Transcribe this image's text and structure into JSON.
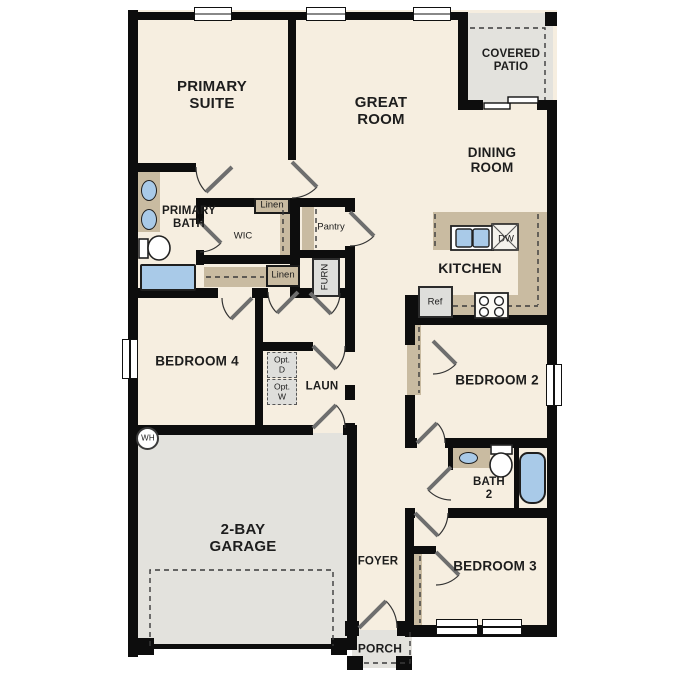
{
  "labels": {
    "primary_suite": "PRIMARY SUITE",
    "great_room": "GREAT ROOM",
    "covered_patio": "COVERED PATIO",
    "dining_room": "DINING ROOM",
    "primary_bath": "PRIMARY BATH",
    "wic": "WIC",
    "linen_upper": "Linen",
    "linen_lower": "Linen",
    "pantry": "Pantry",
    "furnace": "FURN",
    "kitchen": "KITCHEN",
    "dishwasher": "DW",
    "refrigerator": "Ref",
    "bedroom4": "BEDROOM 4",
    "opt_dryer": "Opt. D",
    "opt_washer": "Opt. W",
    "laundry": "LAUN",
    "bedroom2": "BEDROOM 2",
    "water_heater": "WH",
    "bath2": "BATH 2",
    "garage": "2-BAY GARAGE",
    "foyer": "FOYER",
    "bedroom3": "BEDROOM 3",
    "porch": "PORCH"
  },
  "colors": {
    "floor": "#f6eee0",
    "wall": "#0d0d0d",
    "casework": "#c9bba1",
    "concrete": "#e3e2dd",
    "fixture": "#a9cae8",
    "appliance": "#dededb",
    "line": "#2a2a2a"
  }
}
